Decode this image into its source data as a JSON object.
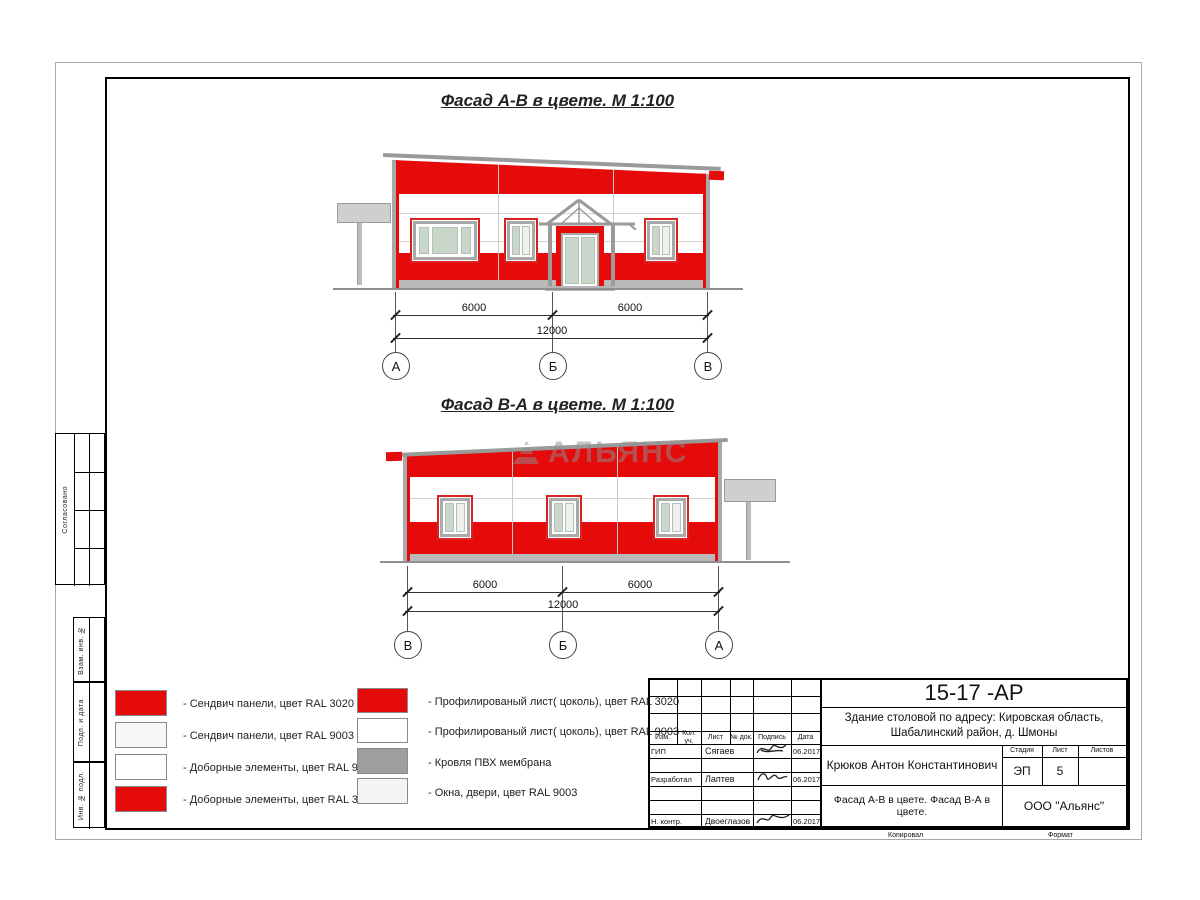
{
  "page": {
    "watermark": "АЛЬЯНС"
  },
  "facade_ab": {
    "title": "Фасад А-В в цвете.  М 1:100",
    "dim_left": "6000",
    "dim_right": "6000",
    "dim_total": "12000",
    "axes": [
      "А",
      "Б",
      "В"
    ]
  },
  "facade_ba": {
    "title": "Фасад В-А в цвете.  М 1:100",
    "dim_left": "6000",
    "dim_right": "6000",
    "dim_total": "12000",
    "axes": [
      "В",
      "Б",
      "А"
    ]
  },
  "legend": {
    "left": [
      {
        "label": "- Сендвич панели, цвет RAL 3020",
        "color": "#e50b0b"
      },
      {
        "label": "- Сендвич панели, цвет RAL 9003",
        "color": "#f7f7f7"
      },
      {
        "label": "- Доборные элементы, цвет RAL 9003",
        "color": "#ffffff"
      },
      {
        "label": "- Доборные элементы, цвет RAL 3020",
        "color": "#e50b0b"
      }
    ],
    "right": [
      {
        "label": "- Профилированый лист( цоколь), цвет RAL 3020",
        "color": "#e50b0b"
      },
      {
        "label": "- Профилированый лист( цоколь), цвет RAL 9003",
        "color": "#ffffff"
      },
      {
        "label": "- Кровля ПВХ мембрана",
        "color": "#9e9e9e"
      },
      {
        "label": "- Окна, двери, цвет RAL 9003",
        "color": "#f4f4f4"
      }
    ]
  },
  "sidebar": {
    "approve": "Согласовано",
    "sections": [
      "Взам. инв. №",
      "Подп. и дата",
      "Инв. № подл."
    ]
  },
  "titleblock": {
    "doc_code": "15-17 -АР",
    "object_line1": "Здание столовой по адресу: Кировская область,",
    "object_line2": "Шабалинский район, д. Шмоны",
    "columns": [
      "Изм.",
      "Кол. уч.",
      "Лист",
      "№ док.",
      "Подпись",
      "Дата"
    ],
    "rows": [
      {
        "role": "ГИП",
        "name": "Сягаев",
        "date": "06.2017"
      },
      {
        "role": "Разработал",
        "name": "Лаптев",
        "date": "06.2017"
      },
      {
        "role": "Н. контр.",
        "name": "Двоеглазов",
        "date": "06.2017"
      }
    ],
    "author": "Крюков Антон Константинович",
    "stage_label": "Стадия",
    "sheet_label": "Лист",
    "sheets_label": "Листов",
    "stage": "ЭП",
    "sheet_no": "5",
    "sheets_total": "",
    "subtitle": "Фасад А-В в цвете. Фасад В-А в цвете.",
    "company": "ООО \"Альянс\"",
    "copied_label": "Копировал",
    "format_label": "Формат"
  }
}
